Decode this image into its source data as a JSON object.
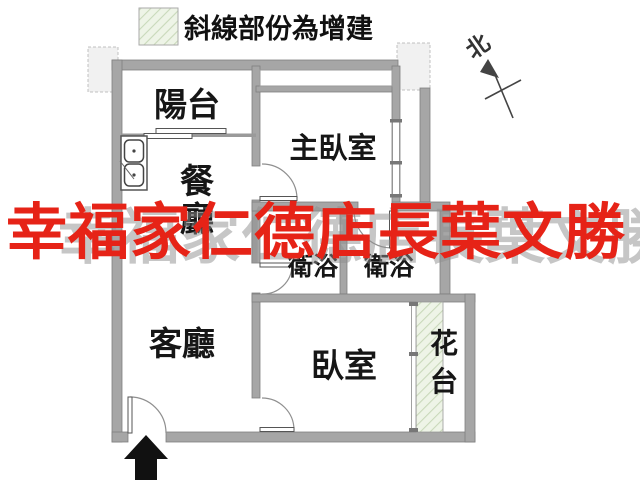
{
  "legend": {
    "text": "斜線部份為增建"
  },
  "compass": {
    "label": "北"
  },
  "watermark": {
    "red_text": "幸福家仁德店長葉文勝",
    "gray_text": "幸福家仁德店長葉文勝"
  },
  "rooms": {
    "balcony": "陽台",
    "master_bedroom": "主臥室",
    "dining_char1": "餐",
    "dining_char2": "廳",
    "living": "客廳",
    "bath_left": "衛浴",
    "bath_right": "衛浴",
    "bedroom": "臥室",
    "flower_char1": "花",
    "flower_char2": "台"
  },
  "colors": {
    "wall": "#a6a6a6",
    "wall_edge": "#7f7f7f",
    "hatch_fill": "#eef4e7",
    "hatch_line": "#c9d9ba",
    "dashed_box_fill": "#f1f1f1",
    "watermark_red": "#e62317",
    "watermark_gray": "#8f8f8f"
  }
}
